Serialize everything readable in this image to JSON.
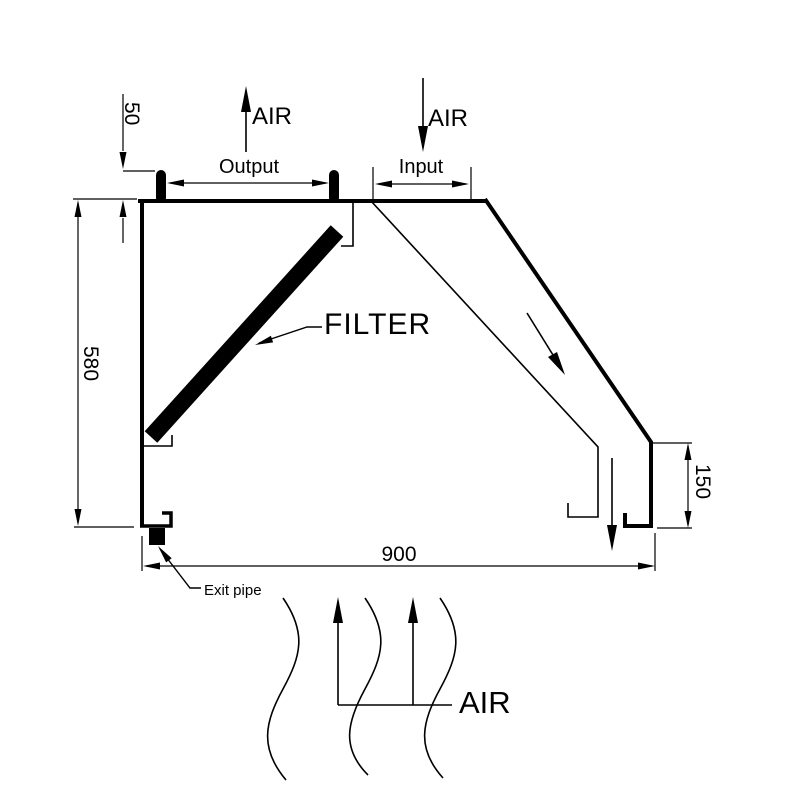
{
  "page": {
    "background": "#ffffff",
    "line_color": "#000000"
  },
  "labels": {
    "air_output": "AIR",
    "air_input": "AIR",
    "air_rising": "AIR",
    "output": "Output",
    "input": "Input",
    "filter": "FILTER",
    "exit_pipe": "Exit pipe"
  },
  "dimensions": {
    "collar_height": "50",
    "hood_height": "580",
    "hood_width": "900",
    "outlet_height": "150"
  }
}
